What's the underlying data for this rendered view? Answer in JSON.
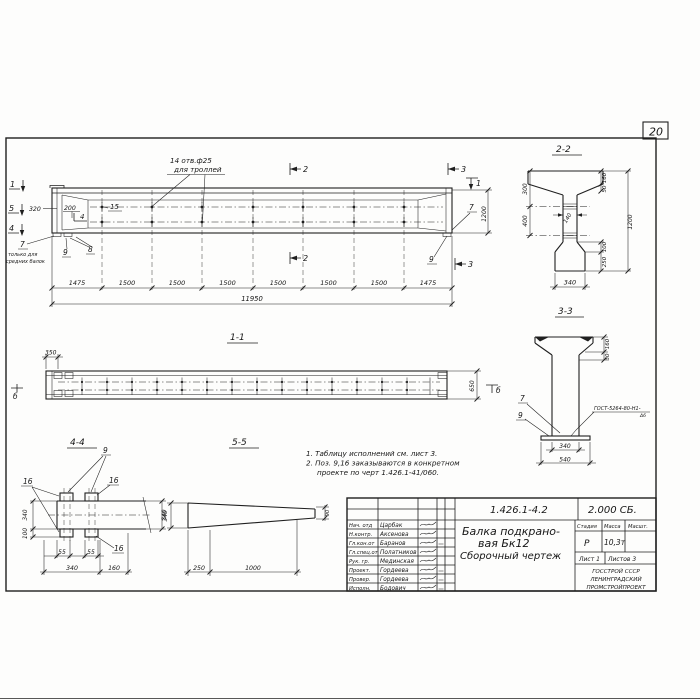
{
  "page": {
    "sheet_number": "20"
  },
  "main_view": {
    "callout": {
      "line1": "14 отв.ф25",
      "line2": "для троллей"
    },
    "marks": {
      "left1": "1",
      "left5": "5",
      "left4": "4",
      "top2": "2",
      "bottom2": "2",
      "top3": "3",
      "bottom3": "3",
      "right1": "1",
      "inner4": "4"
    },
    "positions": {
      "p15": "15",
      "p7_left": "7",
      "p8": "8",
      "p9_left": "9",
      "p7_right": "7",
      "p9_right": "9"
    },
    "pos7_note": {
      "line1": "только для",
      "line2": "средних балок"
    },
    "dims": {
      "d320": "320",
      "d200": "200",
      "d1200": "1200",
      "segments": [
        "1475",
        "1500",
        "1500",
        "1500",
        "1500",
        "1500",
        "1500",
        "1475"
      ],
      "total": "11950"
    }
  },
  "section_2_2": {
    "title": "2-2",
    "dims": {
      "left300": "300",
      "left400": "400",
      "web140": "140",
      "right160": "160",
      "right50": "50",
      "right100": "100",
      "right250": "250",
      "right1200": "1200",
      "bottom340": "340"
    }
  },
  "section_3_3": {
    "title": "3-3",
    "positions": {
      "p7": "7",
      "p9": "9"
    },
    "weld_note": {
      "line1": "ГОСТ-5264-80-Н1-",
      "line2": "Δ6"
    },
    "dims": {
      "right160": "160",
      "right30": "30",
      "bottom340": "340",
      "bottom540": "540"
    }
  },
  "section_1_1": {
    "title": "1-1",
    "marks": {
      "b_left": "б",
      "b_right": "б"
    },
    "dims": {
      "d350": "350",
      "d650": "650"
    }
  },
  "section_4_4": {
    "title": "4-4",
    "positions": {
      "p9": "9",
      "p16_left": "16",
      "p16_top": "16",
      "p16_bottom": "16"
    },
    "dims": {
      "left340": "340",
      "left100": "100",
      "bottom55a": "55",
      "bottom55b": "55",
      "bottom340": "340",
      "bottom160": "160",
      "right340": "340"
    }
  },
  "section_5_5": {
    "title": "5-5",
    "dims": {
      "left340": "340",
      "bottom250": "250",
      "bottom1000": "1000",
      "right90": "90"
    }
  },
  "notes": {
    "line1": "1. Таблицу исполнений см. лист 3.",
    "line2": "2. Поз. 9,16 заказываются в конкретном",
    "line3": "проекте по черт 1.426.1-41/060."
  },
  "title_block": {
    "doc_number": "1.426.1-4.2",
    "doc_code": "2.000 СБ.",
    "title_line1": "Балка подкрано-",
    "title_line2": "вая Бк12",
    "title_line3": "Сборочный чертеж",
    "headers": {
      "stage": "Стадия",
      "mass": "Масса",
      "scale": "Масшт."
    },
    "values": {
      "stage": "Р",
      "mass": "10,3т"
    },
    "sheet": {
      "list": "Лист 1",
      "listov": "Листов 3"
    },
    "org": {
      "line1": "ГОССТРОЙ СССР",
      "line2": "ЛЕНИНГРАДСКИЙ",
      "line3": "ПРОМСТРОЙПРОЕКТ"
    },
    "staff": [
      {
        "role": "Нач. отд",
        "name": "Царбак"
      },
      {
        "role": "Н.контр.",
        "name": "Аксенова"
      },
      {
        "role": "Гл.кон.от",
        "name": "Баранов"
      },
      {
        "role": "Гл.спец.от",
        "name": "Полатников"
      },
      {
        "role": "Рук. гр.",
        "name": "Мединская"
      },
      {
        "role": "Проект.",
        "name": "Гордеева"
      },
      {
        "role": "Провер.",
        "name": "Гордеева"
      },
      {
        "role": "Исполн.",
        "name": "Бодович"
      }
    ]
  }
}
